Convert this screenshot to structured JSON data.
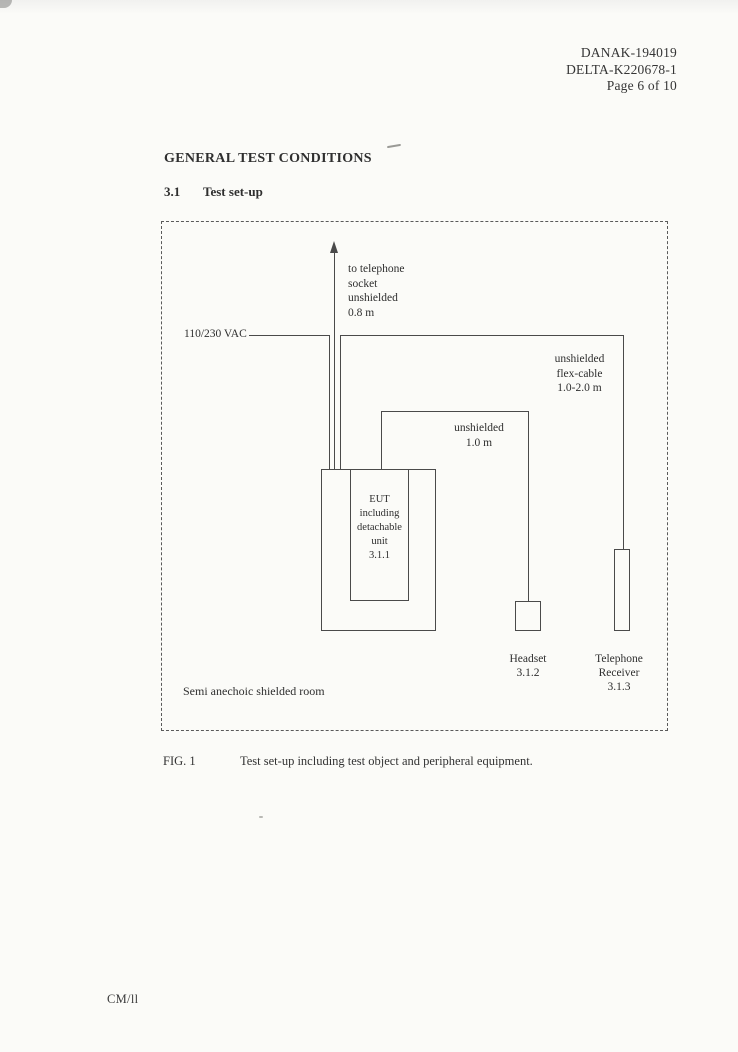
{
  "colors": {
    "ink": "#2f2f2f",
    "line": "#4a4a4a",
    "paper": "#fbfbf8"
  },
  "header": {
    "lines": [
      "DANAK-194019",
      "DELTA-K220678-1",
      "Page 6 of 10"
    ]
  },
  "body": {
    "heading": "GENERAL TEST CONDITIONS",
    "section_number": "3.1",
    "section_title": "Test set-up"
  },
  "diagram": {
    "power_label": "110/230 VAC",
    "telephone_cable": {
      "lines": [
        "to telephone",
        "socket",
        "unshielded",
        "0.8 m"
      ]
    },
    "flex_cable": {
      "lines": [
        "unshielded",
        "flex-cable",
        "1.0-2.0 m"
      ]
    },
    "headset_cable": {
      "lines": [
        "unshielded",
        "1.0 m"
      ]
    },
    "eut": {
      "lines": [
        "EUT",
        "including",
        "detachable",
        "unit",
        "3.1.1"
      ]
    },
    "headset": {
      "lines": [
        "Headset",
        "3.1.2"
      ]
    },
    "receiver": {
      "lines": [
        "Telephone",
        "Receiver",
        "3.1.3"
      ]
    },
    "room_label": "Semi anechoic shielded room"
  },
  "caption": {
    "label": "FIG. 1",
    "text": "Test set-up including test object and peripheral equipment."
  },
  "footer": "CM/ll"
}
